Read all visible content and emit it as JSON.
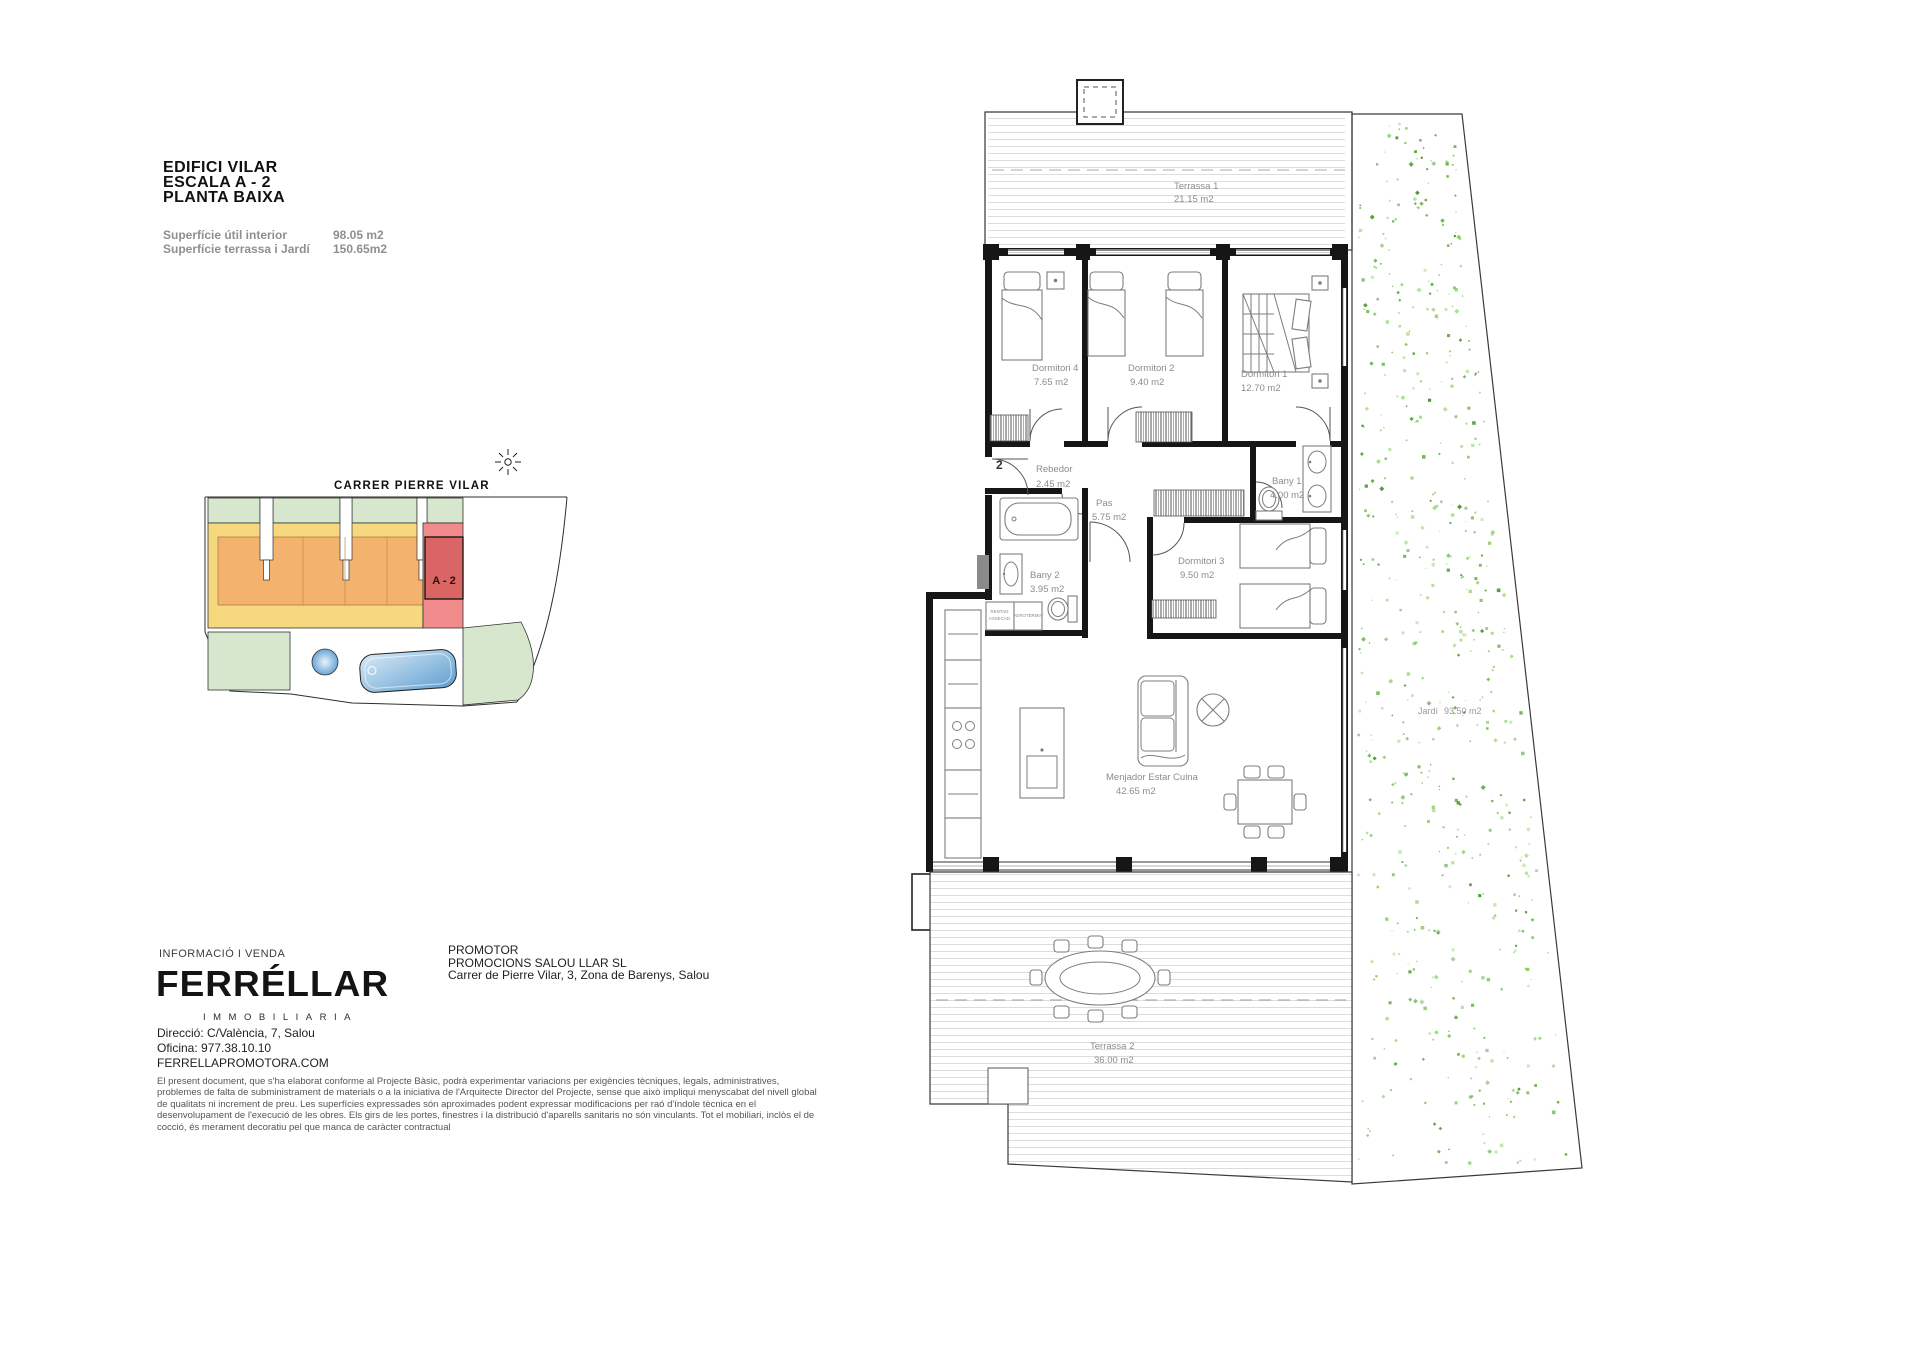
{
  "header": {
    "building": "EDIFICI VILAR",
    "staircase": "ESCALA A - 2",
    "floor": "PLANTA BAIXA",
    "surface_interior_label": "Superfície útil interior",
    "surface_interior_value": "98.05 m2",
    "surface_terrace_label": "Superfície terrassa i Jardí",
    "surface_terrace_value": "150.65m2"
  },
  "site_plan": {
    "street": "CARRER  PIERRE VILAR",
    "highlighted_unit": "A - 2"
  },
  "floor_plan": {
    "entry_number": "2",
    "rooms": [
      {
        "name": "Dormitori 4",
        "area": "7.65 m2"
      },
      {
        "name": "Dormitori 2",
        "area": "9.40 m2"
      },
      {
        "name": "Dormitori 1",
        "area": "12.70 m2"
      },
      {
        "name": "Rebedor",
        "area": "2.45 m2"
      },
      {
        "name": "Pas",
        "area": "5.75 m2"
      },
      {
        "name": "Bany 1",
        "area": "4.00 m2"
      },
      {
        "name": "Bany 2",
        "area": "3.95 m2"
      },
      {
        "name": "Dormitori 3",
        "area": "9.50 m2"
      },
      {
        "name": "Menjador  Estar  Cuina",
        "area": "42.65 m2"
      },
      {
        "name": "Terrassa 1",
        "area": "21.15 m2"
      },
      {
        "name": "Terrassa 2",
        "area": "36.00 m2"
      },
      {
        "name": "Jardí",
        "area": "93.50 m2"
      }
    ],
    "appliances": {
      "washer": "RENTAD.",
      "dryer": "ASSECAD.",
      "heatpump": "AEROTÈRMIA"
    }
  },
  "footer": {
    "info_title": "INFORMACIÓ I VENDA",
    "logo": "FERRÉLLAR",
    "logo_sub": "IMMOBILIARIA",
    "address": "Direcció: C/València, 7, Salou",
    "phone": "Oficina: 977.38.10.10",
    "website": "FERRELLAPROMOTORA.COM",
    "promoter_title": "PROMOTOR",
    "promoter_name": "PROMOCIONS SALOU LLAR SL",
    "promoter_address": "Carrer de Pierre Vilar, 3, Zona de Barenys, Salou",
    "disclaimer": "El present document, que s'ha elaborat conforme al Projecte Bàsic, podrà experimentar variacions per exigències tècniques, legals, administratives, problemes de falta de subministrament de materials o a la iniciativa de l'Arquitecte Director del Projecte, sense que això impliqui menyscabat del nivell global de qualitats ni increment de preu. Les superfícies expressades són aproximades podent expressar modificacions per raó d'índole tècnica en el desenvolupament de l'execució de les obres. Els girs de les portes, finestres i la distribució d'aparells sanitaris no són vinculants. Tot el mobiliari, inclòs el de cocció, és merament decoratiu pel que manca de caràcter contractual"
  },
  "colors": {
    "site_green": "#d7e7cd",
    "site_yellow": "#f6d97e",
    "site_orange": "#f3b26e",
    "site_red_band": "#f28b8b",
    "site_unit_red": "#d96565",
    "pool_blue": "#6aa5d8",
    "garden_speckle_green": "#53b02f",
    "wall_black": "#161616",
    "label_gray": "#8c8c8c"
  }
}
